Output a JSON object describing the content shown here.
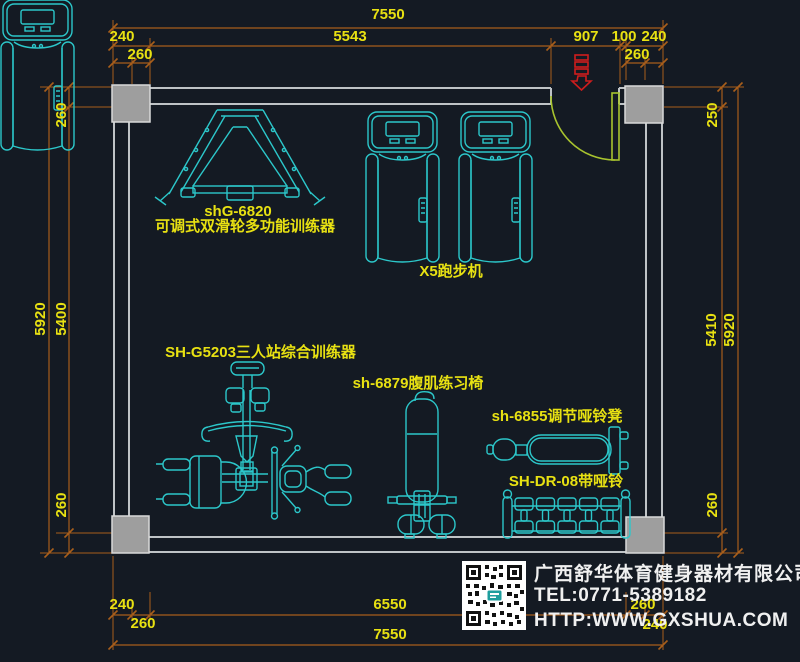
{
  "drawing_title": "gym-equipment-floor-plan",
  "colors": {
    "background": "#141a23",
    "dimension_line": "#a85e1b",
    "dimension_text": "#e8e112",
    "equipment": "#2cc7ca",
    "wall": "#bfc3c6",
    "door": "#a8c32e",
    "entry_marker": "#cf1d1d"
  },
  "dims": {
    "top": {
      "total": "7550",
      "segments": [
        "240",
        "5543",
        "907",
        "100",
        "240"
      ],
      "insets": [
        "260",
        "260"
      ]
    },
    "left": {
      "outer": "5920",
      "inner": "5400",
      "top": "260",
      "bottom": "260"
    },
    "right": {
      "outer": "5920",
      "inner": "5410",
      "top": "250",
      "bottom": "260"
    },
    "bottom": {
      "total": "7550",
      "segments": [
        "240",
        "6550",
        "260"
      ],
      "insets": [
        "260",
        "240"
      ]
    }
  },
  "equipment": {
    "pulley_trainer_model": "shG-6820",
    "pulley_trainer_name": "可调式双滑轮多功能训练器",
    "treadmill_label": "X5跑步机",
    "multi_station_label": "SH-G5203三人站综合训练器",
    "ab_bench_label": "sh-6879腹肌练习椅",
    "adj_bench_label": "sh-6855调节哑铃凳",
    "dumbbell_rack_label": "SH-DR-08带哑铃"
  },
  "company": {
    "name": "广西舒华体育健身器材有限公司",
    "tel": "TEL:0771-5389182",
    "website": "HTTP:WWW.GXSHUA.COM"
  }
}
